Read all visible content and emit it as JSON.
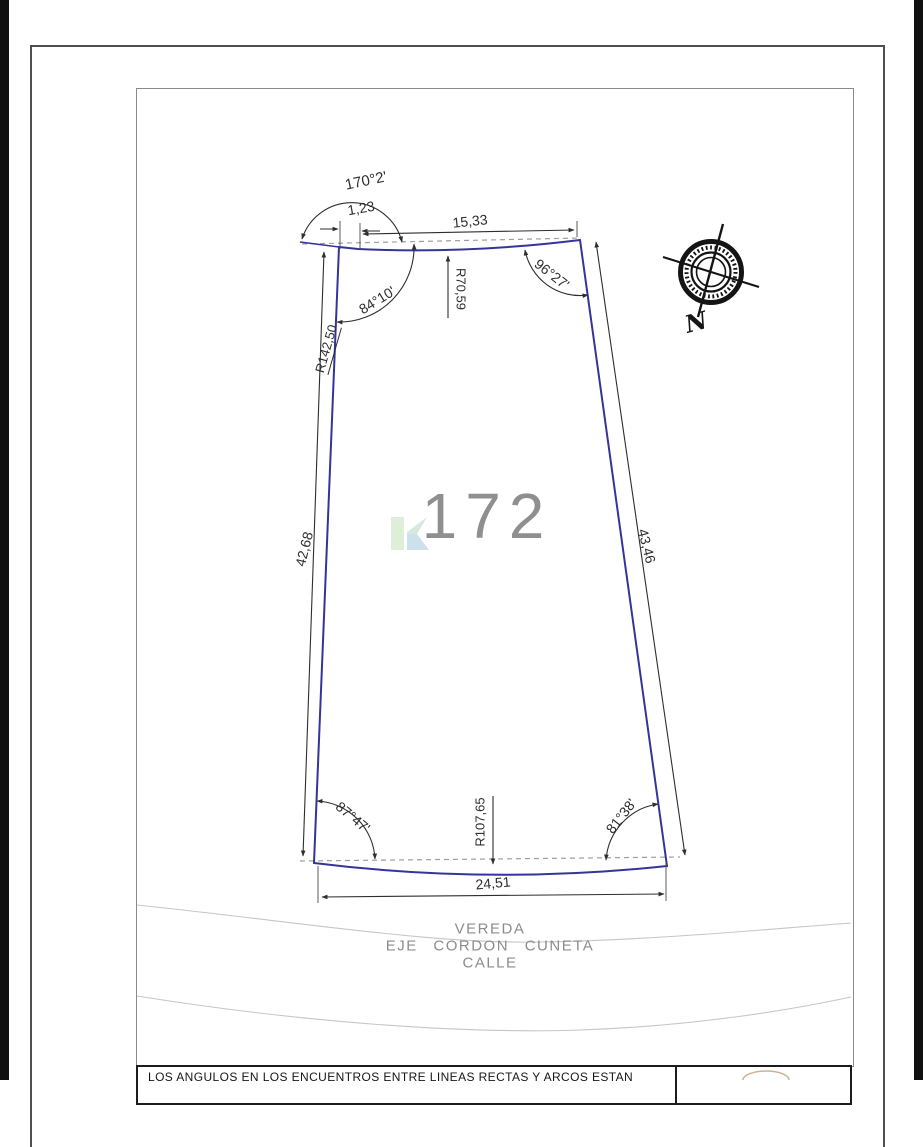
{
  "lot": {
    "number": "172",
    "dimensions": {
      "top": "15,33",
      "jog": "1,23",
      "left": "42,68",
      "right": "43,46",
      "bottom": "24,51"
    },
    "radii": {
      "top": "R70,59",
      "left": "R142,50",
      "bottom": "R107,65"
    },
    "angles": {
      "top_left_outer": "170°2'",
      "top_left": "84°10'",
      "top_right": "96°27'",
      "bottom_left": "87°47'",
      "bottom_right": "81°38'"
    }
  },
  "street_labels": {
    "vereda": "VEREDA",
    "eje": "EJE CORDON CUNETA",
    "calle": "CALLE"
  },
  "compass": {
    "north_label": "N"
  },
  "watermark": {
    "letter": "K"
  },
  "title_block": {
    "note_line": "LOS ANGULOS EN LOS ENCUENTROS ENTRE LINEAS RECTAS Y ARCOS ESTAN"
  },
  "colors": {
    "boundary": "#34349a",
    "dimension": "#2e2e2e",
    "muted_text": "#8f8f8f",
    "wave": "#c6c6c6",
    "frame_outer": "#4f4f4f",
    "frame_inner": "#8a8a8a"
  }
}
